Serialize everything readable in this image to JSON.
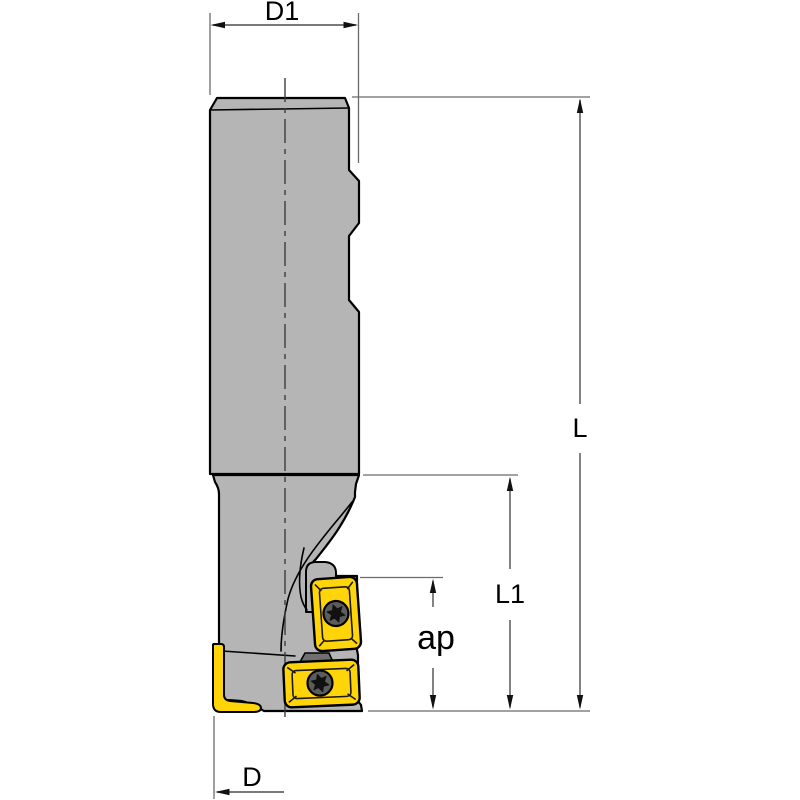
{
  "drawing": {
    "kind": "technical-dimension-drawing",
    "subject": "indexable-shoulder-end-mill-side-view",
    "background": "#ffffff",
    "colors": {
      "body_gray": "#b5b5b5",
      "insert_yellow": "#ffd50a",
      "screw_gray": "#5c5c5c",
      "shim_dark_gray": "#707070",
      "outline_black": "#000000",
      "dimension_line_gray": "#4d4d4d"
    },
    "dimension_labels": {
      "d1": "D1",
      "l": "L",
      "l1": "L1",
      "ap": "ap",
      "d": "D"
    },
    "dimensions": [
      {
        "label": "D1",
        "orientation": "horizontal",
        "position": "top"
      },
      {
        "label": "L",
        "orientation": "vertical",
        "position": "right-outer"
      },
      {
        "label": "L1",
        "orientation": "vertical",
        "position": "right-inner"
      },
      {
        "label": "ap",
        "orientation": "vertical",
        "position": "beside-inserts"
      },
      {
        "label": "D",
        "orientation": "horizontal",
        "position": "bottom-left"
      }
    ],
    "parts": [
      "cylindrical-shank-with-flats",
      "neck",
      "cutter-head-with-flute",
      "upper-indexable-insert",
      "lower-indexable-insert",
      "wiper-insert-edge-view",
      "torx-clamp-screws",
      "center-axis-line"
    ]
  }
}
